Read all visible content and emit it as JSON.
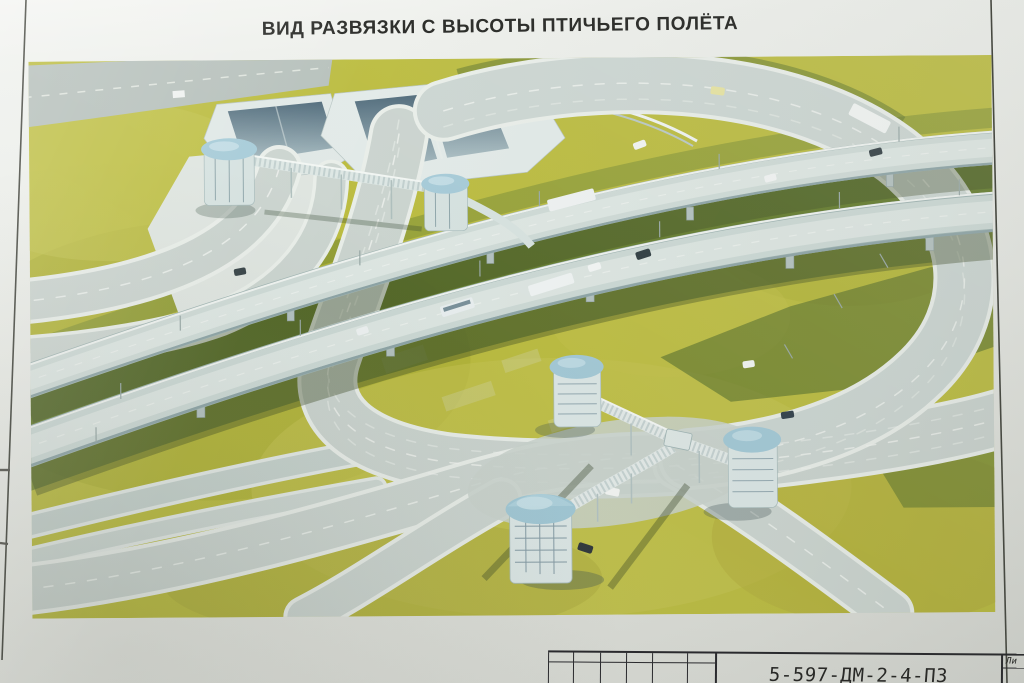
{
  "sheet": {
    "title": "ВИД РАЗВЯЗКИ С ВЫСОТЫ ПТИЧЬЕГО ПОЛЁТА"
  },
  "title_block": {
    "document_number": "5-597-ДМ-2-4-ПЗ",
    "sheet_column_label": "Ли"
  },
  "illustration": {
    "alt_description": "Аэровид транспортной развязки: двухуровневые эстакады, два тоннельных портала, кольцевой съезд и надземные пешеходные переходы с купольными башнями-павильонами",
    "colors": {
      "paper": "#e8eae5",
      "grass": "#bbbc3f",
      "grass_dark": "#4f6b28",
      "road_surface": "#cbd4cf",
      "road_edge": "#edf1ed",
      "tunnel_portal": "#587280",
      "tower_dome": "#a3c9d7",
      "shadow": "#3f5530",
      "frame_line": "#43453f"
    }
  }
}
